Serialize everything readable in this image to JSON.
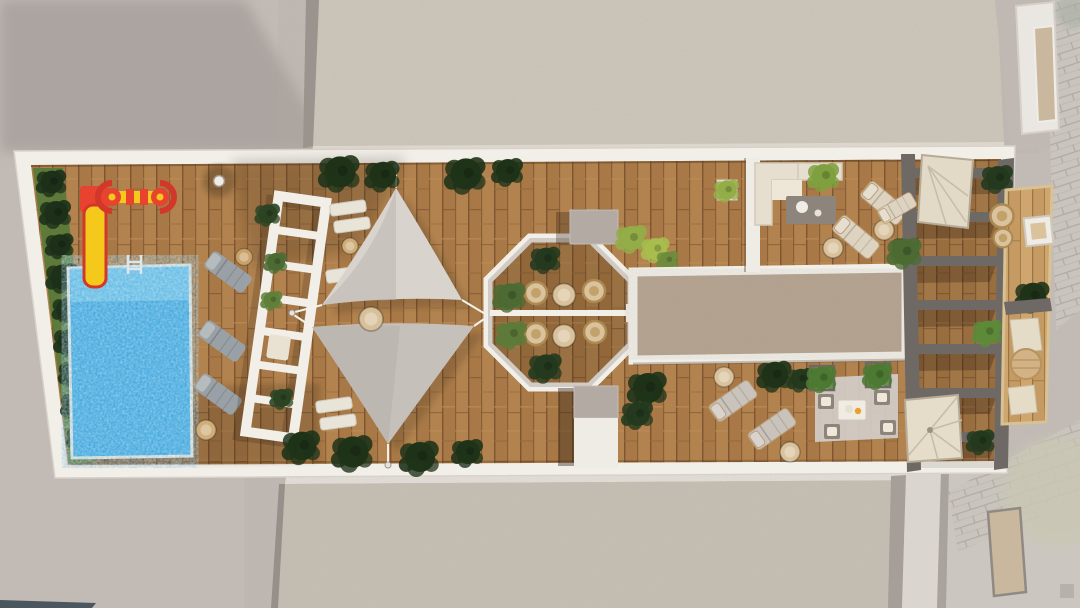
{
  "meta": {
    "title": "Aerial 3D render of a rooftop amenity terrace",
    "view": "top-down architectural visualization",
    "visible_text": ""
  },
  "colors": {
    "background": "#c1bab5",
    "background_shadow": "#aba4a0",
    "gravel_top": "#cfc8bc",
    "gravel_bottom": "#c6c0b5",
    "gravel_rim": "#ddd6cd",
    "deck_frame": "#f2efe9",
    "wood_base": "#a87946",
    "wood_seam": "#7d5530",
    "pool_water": "#3fa8df",
    "pool_light": "#8ed3ef",
    "slide_yellow": "#f5c81c",
    "play_red": "#e8432e",
    "plant_dark": "#243a1e",
    "plant_mid": "#4c6b33",
    "plant_light": "#93ad48",
    "grass": "#5d7a3a",
    "sail_upper": "#d9d3cd",
    "sail_lower": "#c6c0bb",
    "lounger_gray": "#9aa1a6",
    "cushion_cream": "#e6dfcf",
    "table_gray": "#8d847b",
    "wicker_tan": "#d9c29c",
    "pergola_gravel": "#b2a08c",
    "beam_gray": "#6e6965",
    "stone_wall": "#c9c4bd",
    "pavement": "#cbc6c0",
    "rug": "#d2cec8",
    "teal_roof": "#4a575e",
    "window_tan": "#c9b79e",
    "faded_tree": "#c9c7b4"
  },
  "areas": {
    "playground": "kids playground with slide and spinner",
    "pool": "rectangular swimming pool",
    "sun_deck": "gray sun loungers by pool",
    "trellis": "white slatted trellis walk",
    "shade_sails": "twin triangular shade sails",
    "gazebo": "octagonal gazebo with bistro seating",
    "green_roof": "gravel-topped pergola roof",
    "sofa_lounge": "L-shaped sofa lounge",
    "sun_beds": "cream double sun beds",
    "dining": "outdoor dining set on rug",
    "pergola_deck": "slatted pergola deck",
    "side_balcony": "side balcony seating strip",
    "stairs": "fan stair access",
    "street": "street level with stone wall"
  }
}
